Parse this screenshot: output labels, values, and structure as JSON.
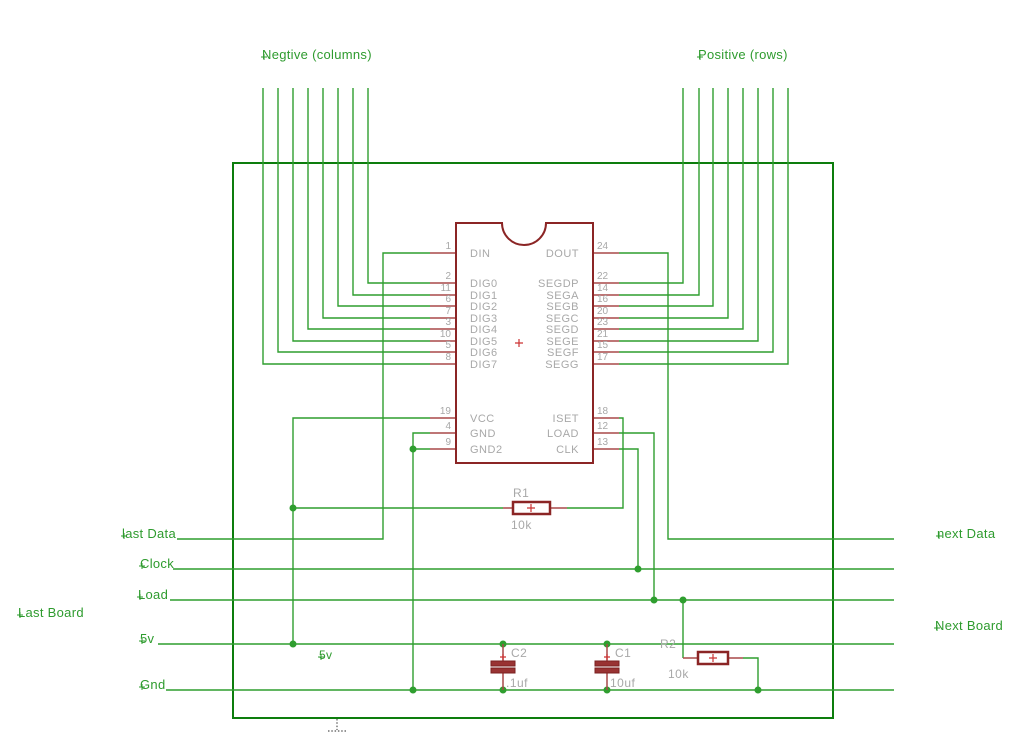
{
  "schematic": {
    "top_labels": {
      "negative_columns": "Negtive (columns)",
      "positive_rows": "Positive (rows)"
    },
    "ic": {
      "left_pins": [
        {
          "num": "1",
          "name": "DIN"
        },
        {
          "num": "2",
          "name": "DIG0"
        },
        {
          "num": "11",
          "name": "DIG1"
        },
        {
          "num": "6",
          "name": "DIG2"
        },
        {
          "num": "7",
          "name": "DIG3"
        },
        {
          "num": "3",
          "name": "DIG4"
        },
        {
          "num": "10",
          "name": "DIG5"
        },
        {
          "num": "5",
          "name": "DIG6"
        },
        {
          "num": "8",
          "name": "DIG7"
        },
        {
          "num": "19",
          "name": "VCC"
        },
        {
          "num": "4",
          "name": "GND"
        },
        {
          "num": "9",
          "name": "GND2"
        }
      ],
      "right_pins": [
        {
          "num": "24",
          "name": "DOUT"
        },
        {
          "num": "22",
          "name": "SEGDP"
        },
        {
          "num": "14",
          "name": "SEGA"
        },
        {
          "num": "16",
          "name": "SEGB"
        },
        {
          "num": "20",
          "name": "SEGC"
        },
        {
          "num": "23",
          "name": "SEGD"
        },
        {
          "num": "21",
          "name": "SEGE"
        },
        {
          "num": "15",
          "name": "SEGF"
        },
        {
          "num": "17",
          "name": "SEGG"
        },
        {
          "num": "18",
          "name": "ISET"
        },
        {
          "num": "12",
          "name": "LOAD"
        },
        {
          "num": "13",
          "name": "CLK"
        }
      ]
    },
    "components": {
      "r1": {
        "ref": "R1",
        "value": "10k"
      },
      "r2": {
        "ref": "R2",
        "value": "10k"
      },
      "c1": {
        "ref": "C1",
        "value": "10uf"
      },
      "c2": {
        "ref": "C2",
        "value": ".1uf"
      }
    },
    "net_labels": {
      "last_data": "last Data",
      "clock": "Clock",
      "load": "Load",
      "last_board": "Last Board",
      "v5": "5v",
      "gnd": "Gnd",
      "v5_small": "5v",
      "next_data": "next Data",
      "next_board": "Next Board"
    },
    "colors": {
      "wire_green": "#2f9e2f",
      "outline_green": "#0d7d0d",
      "component_red": "#8b2525",
      "stub_red": "#a84848",
      "text_gray": "#a8a8a8",
      "label_green": "#2e9b2e"
    }
  }
}
